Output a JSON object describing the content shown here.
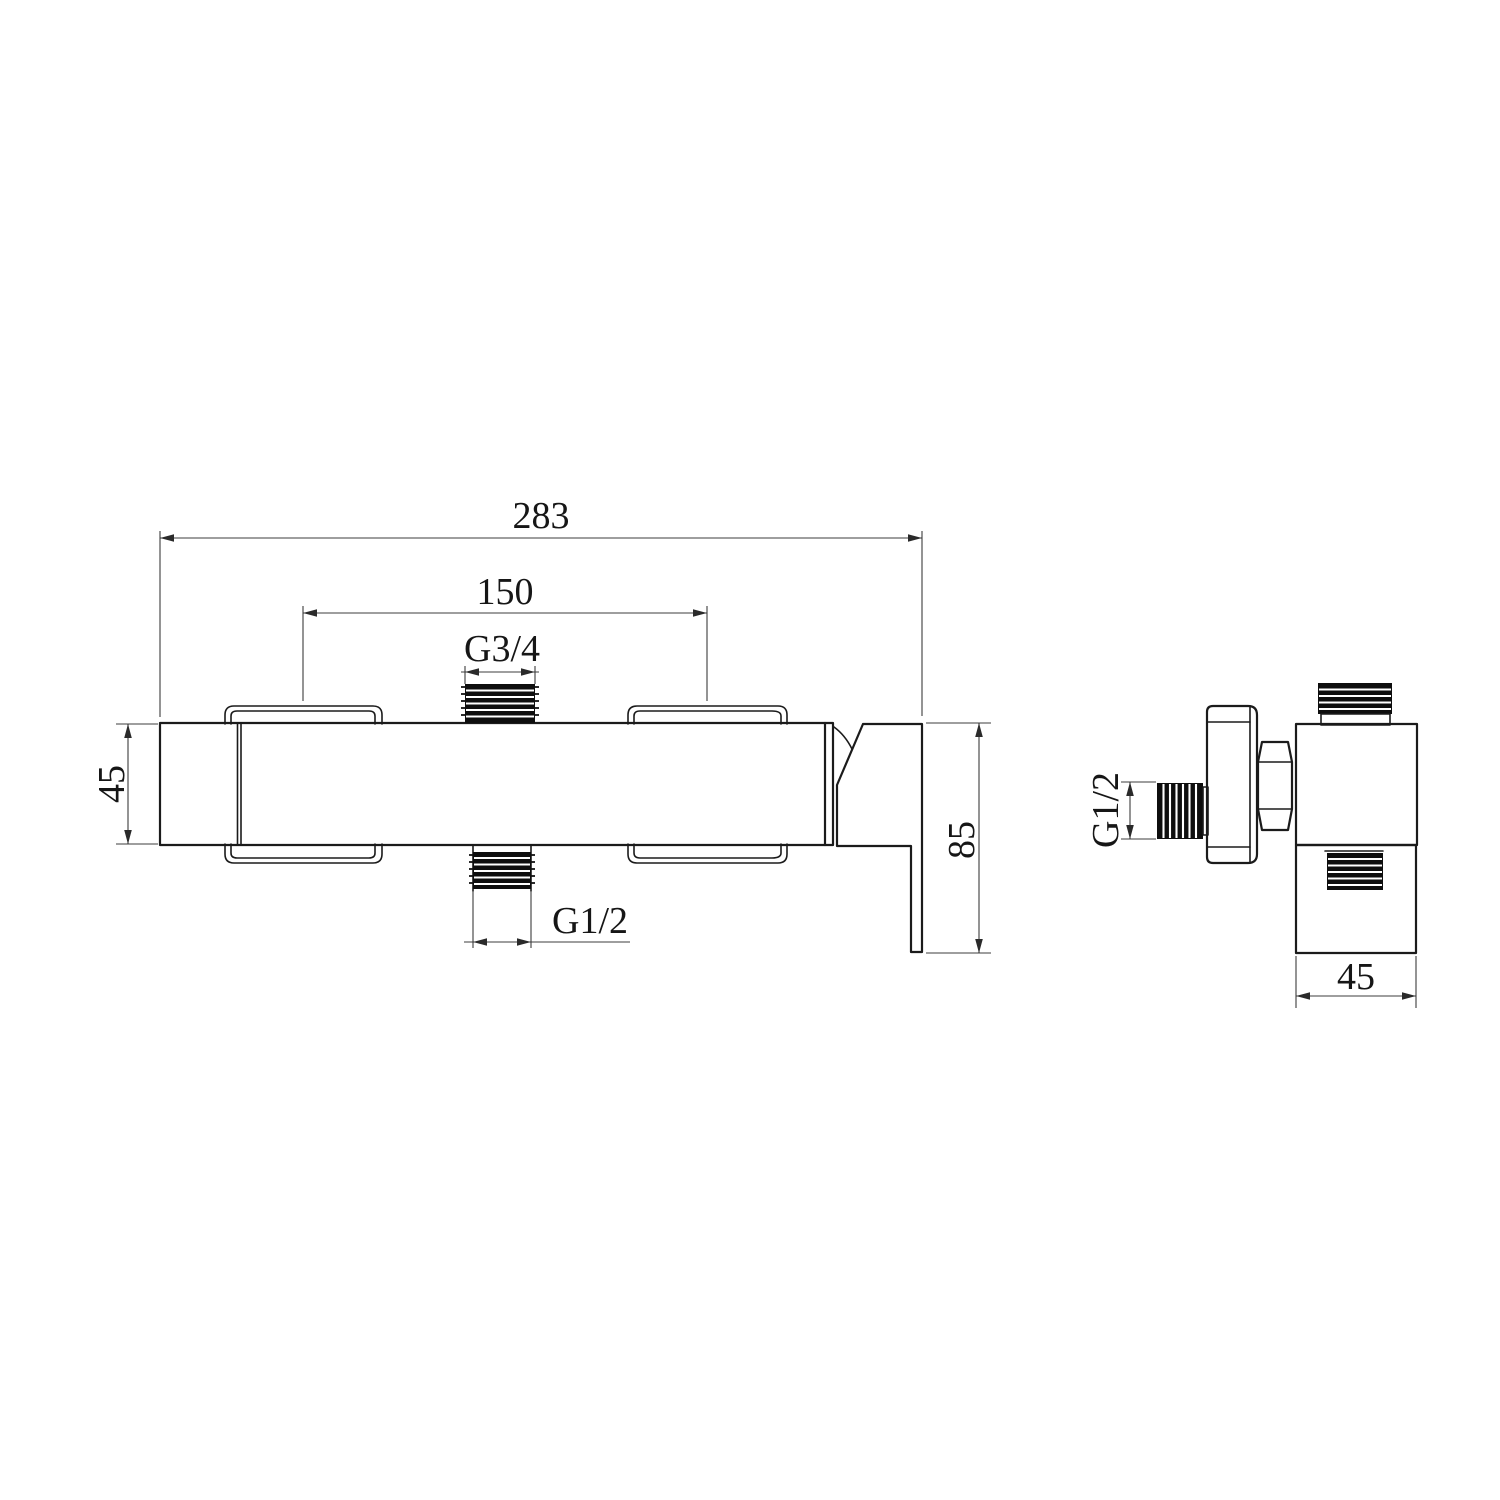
{
  "drawing": {
    "type": "technical-dimension-drawing",
    "subject": "wall-mounted shower mixer valve, front and side orthographic views",
    "colors": {
      "background": "#ffffff",
      "object_line": "#1b1b1b",
      "dimension_line": "#3c3c3c",
      "text": "#161616"
    },
    "front_view": {
      "dims": {
        "overall_width": "283",
        "center_spacing": "150",
        "top_thread": "G3/4",
        "body_height": "45",
        "bottom_thread": "G1/2",
        "overall_height": "85"
      }
    },
    "side_view": {
      "dims": {
        "inlet_thread": "G1/2",
        "depth": "45"
      }
    }
  }
}
